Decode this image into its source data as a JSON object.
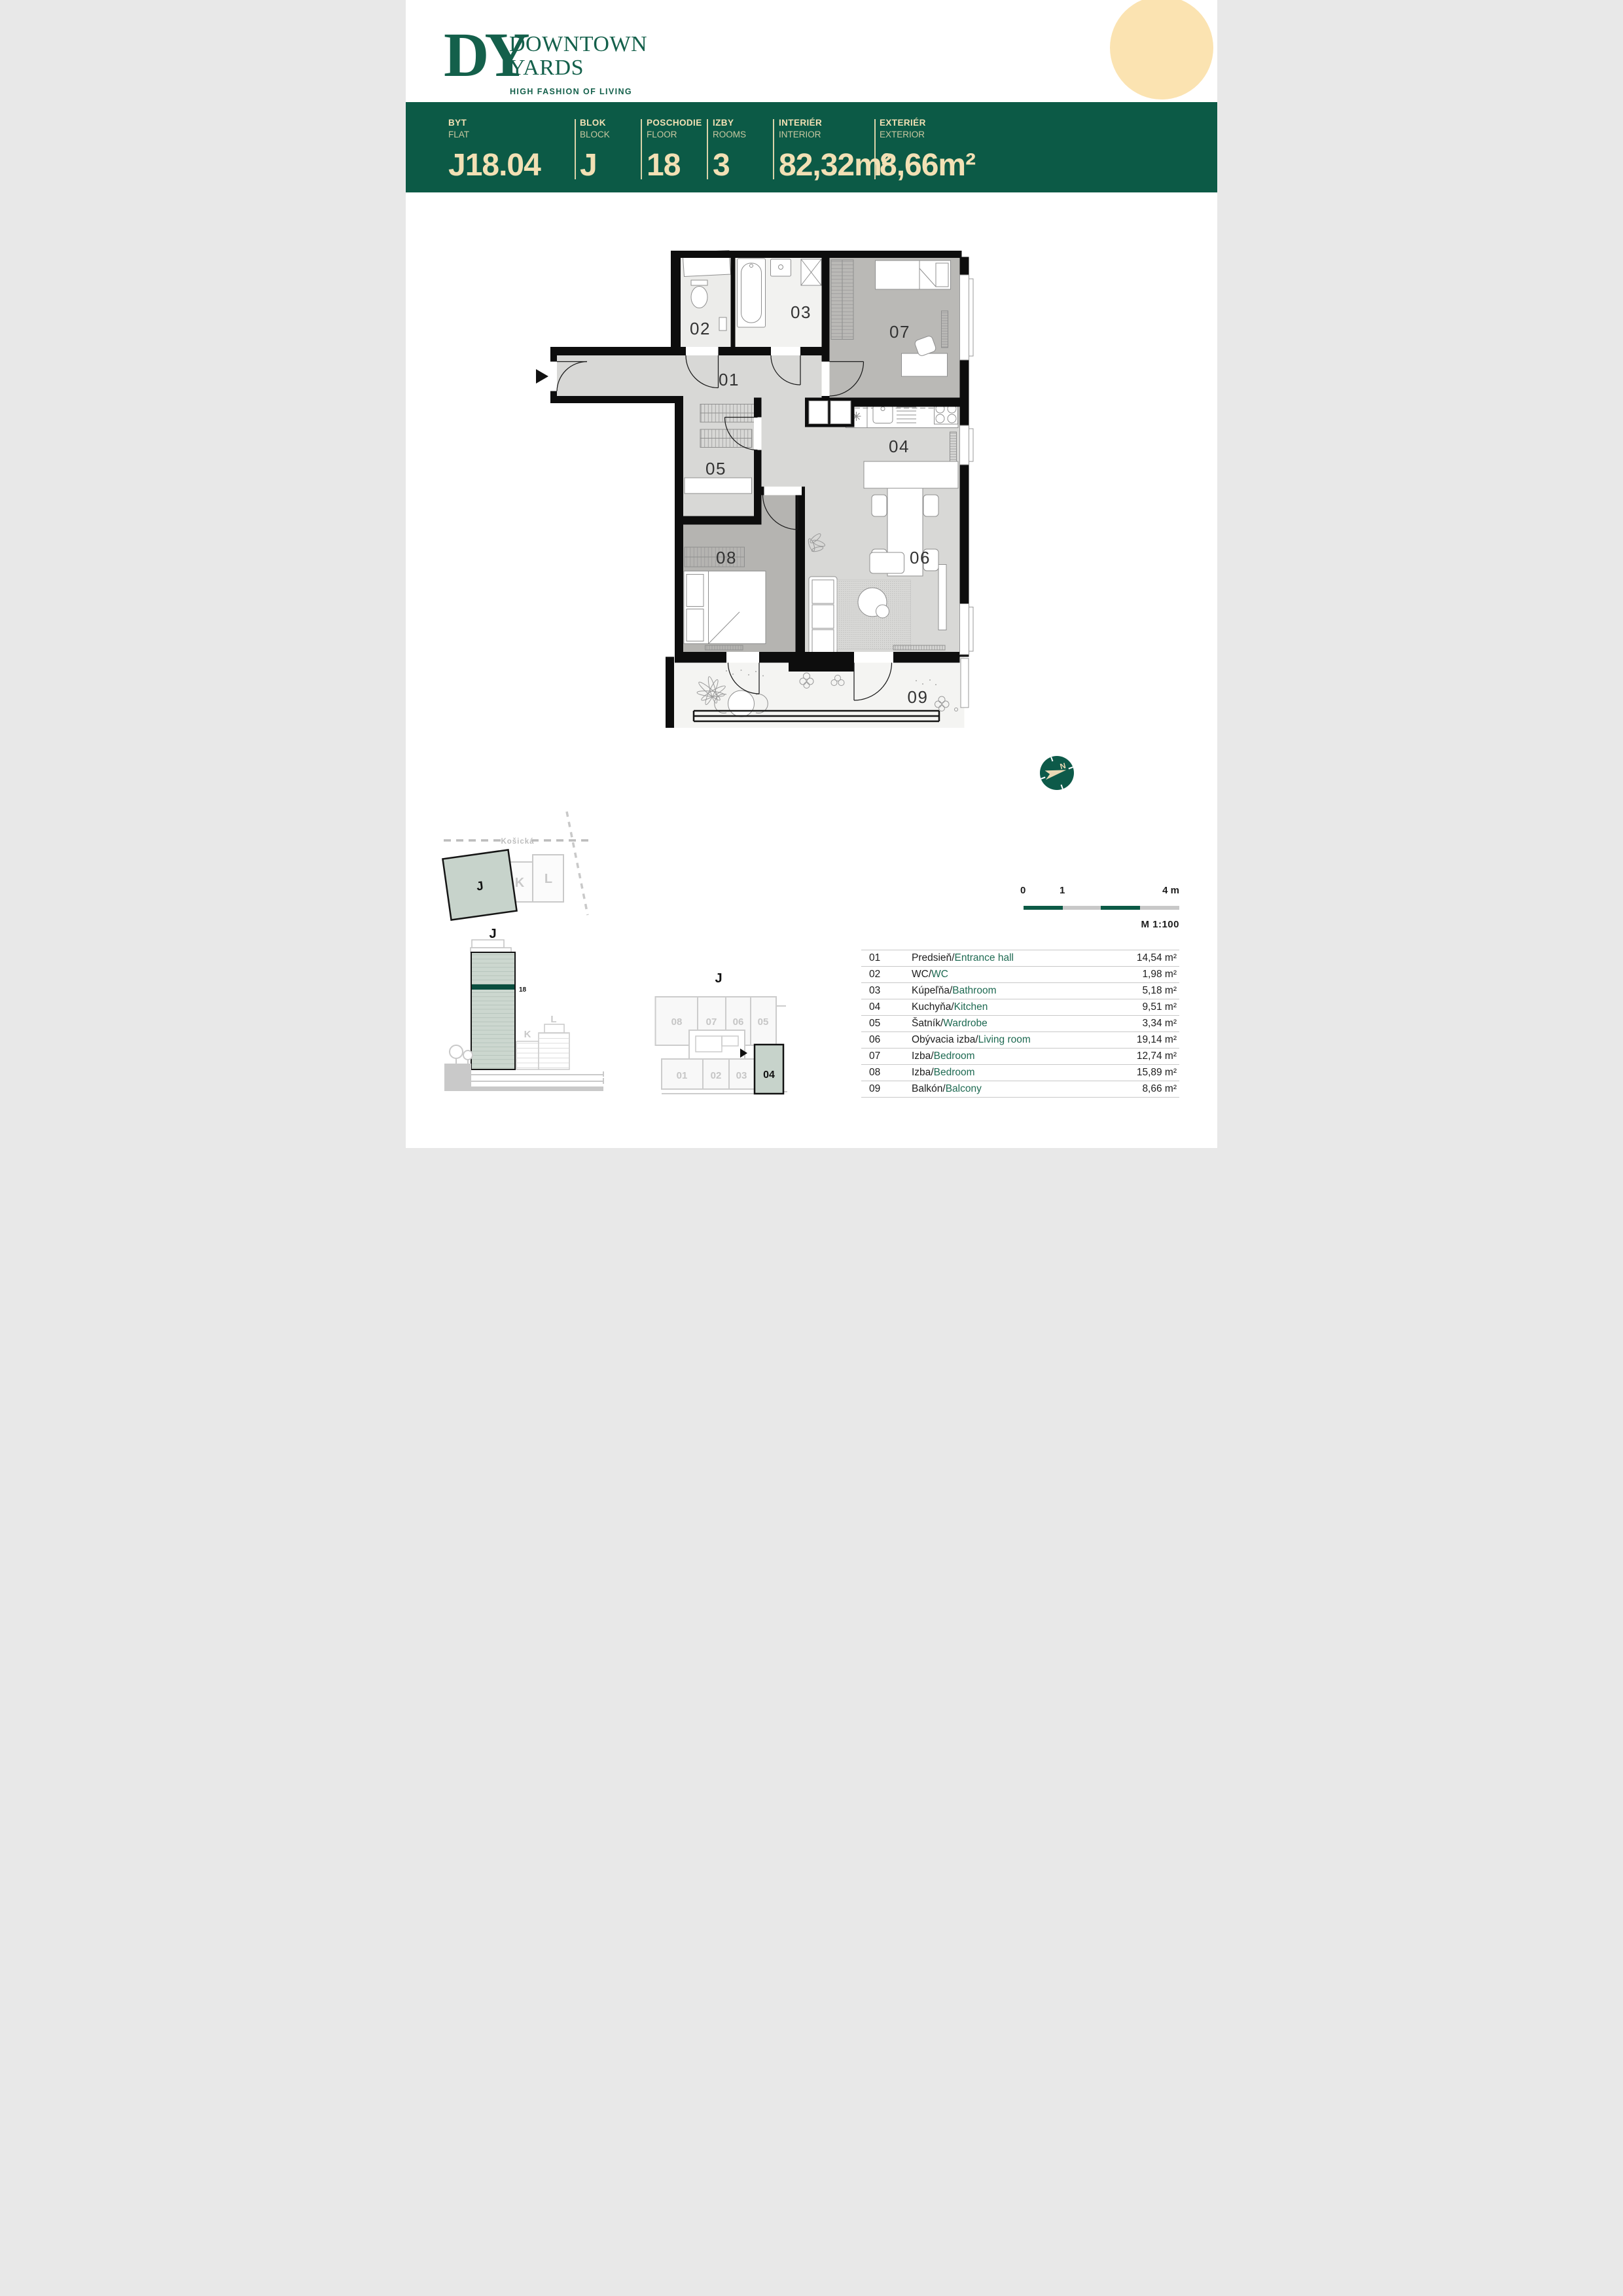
{
  "brand": {
    "monogram": "DY",
    "name_line1": "DOWNTOWN",
    "name_line2": "YARDS",
    "tagline": "HIGH FASHION OF LIVING"
  },
  "header": {
    "fields": [
      {
        "label": "BYT",
        "sublabel": "FLAT",
        "value": "J18.04"
      },
      {
        "label": "BLOK",
        "sublabel": "BLOCK",
        "value": "J"
      },
      {
        "label": "POSCHODIE",
        "sublabel": "FLOOR",
        "value": "18"
      },
      {
        "label": "IZBY",
        "sublabel": "ROOMS",
        "value": "3"
      },
      {
        "label": "INTERIÉR",
        "sublabel": "INTERIOR",
        "value": "82,32m²"
      },
      {
        "label": "EXTERIÉR",
        "sublabel": "EXTERIOR",
        "value": "8,66m²"
      }
    ]
  },
  "plan": {
    "labels": [
      "01",
      "02",
      "03",
      "04",
      "05",
      "06",
      "07",
      "08",
      "09"
    ]
  },
  "site_map": {
    "street": "Košická",
    "blocks": [
      "J",
      "K",
      "L"
    ],
    "highlighted_block": "J"
  },
  "elevation": {
    "title": "J",
    "floor": "18",
    "neighbors": [
      "K",
      "L"
    ]
  },
  "floor_plate": {
    "title": "J",
    "units_top": [
      "08",
      "07",
      "06",
      "05"
    ],
    "units_bottom": [
      "01",
      "02",
      "03"
    ],
    "highlighted_unit": "04"
  },
  "compass": {
    "north_label": "N"
  },
  "scale_bar": {
    "tick0": "0",
    "tick1": "1",
    "tick4": "4 m",
    "ratio": "M 1:100"
  },
  "legend": {
    "separator": "/",
    "rows": [
      {
        "num": "01",
        "sk": "Predsieň",
        "en": "Entrance hall",
        "area": "14,54 m²"
      },
      {
        "num": "02",
        "sk": "WC",
        "en": "WC",
        "area": "1,98 m²"
      },
      {
        "num": "03",
        "sk": "Kúpeľňa",
        "en": "Bathroom",
        "area": "5,18 m²"
      },
      {
        "num": "04",
        "sk": "Kuchyňa",
        "en": "Kitchen",
        "area": "9,51 m²"
      },
      {
        "num": "05",
        "sk": "Šatník",
        "en": "Wardrobe",
        "area": "3,34 m²"
      },
      {
        "num": "06",
        "sk": "Obývacia izba",
        "en": "Living room",
        "area": "19,14 m²"
      },
      {
        "num": "07",
        "sk": "Izba",
        "en": "Bedroom",
        "area": "12,74 m²"
      },
      {
        "num": "08",
        "sk": "Izba",
        "en": "Bedroom",
        "area": "15,89 m²"
      },
      {
        "num": "09",
        "sk": "Balkón",
        "en": "Balcony",
        "area": "8,66 m²"
      }
    ]
  },
  "colors": {
    "brand_green": "#0c5a46",
    "accent_green": "#1e6a52",
    "cream_text": "#f2e0b4",
    "circle_cream": "#fbe3b1",
    "sage_highlight": "#c7d3cb",
    "floor_stripe": "#0a4e3f"
  }
}
